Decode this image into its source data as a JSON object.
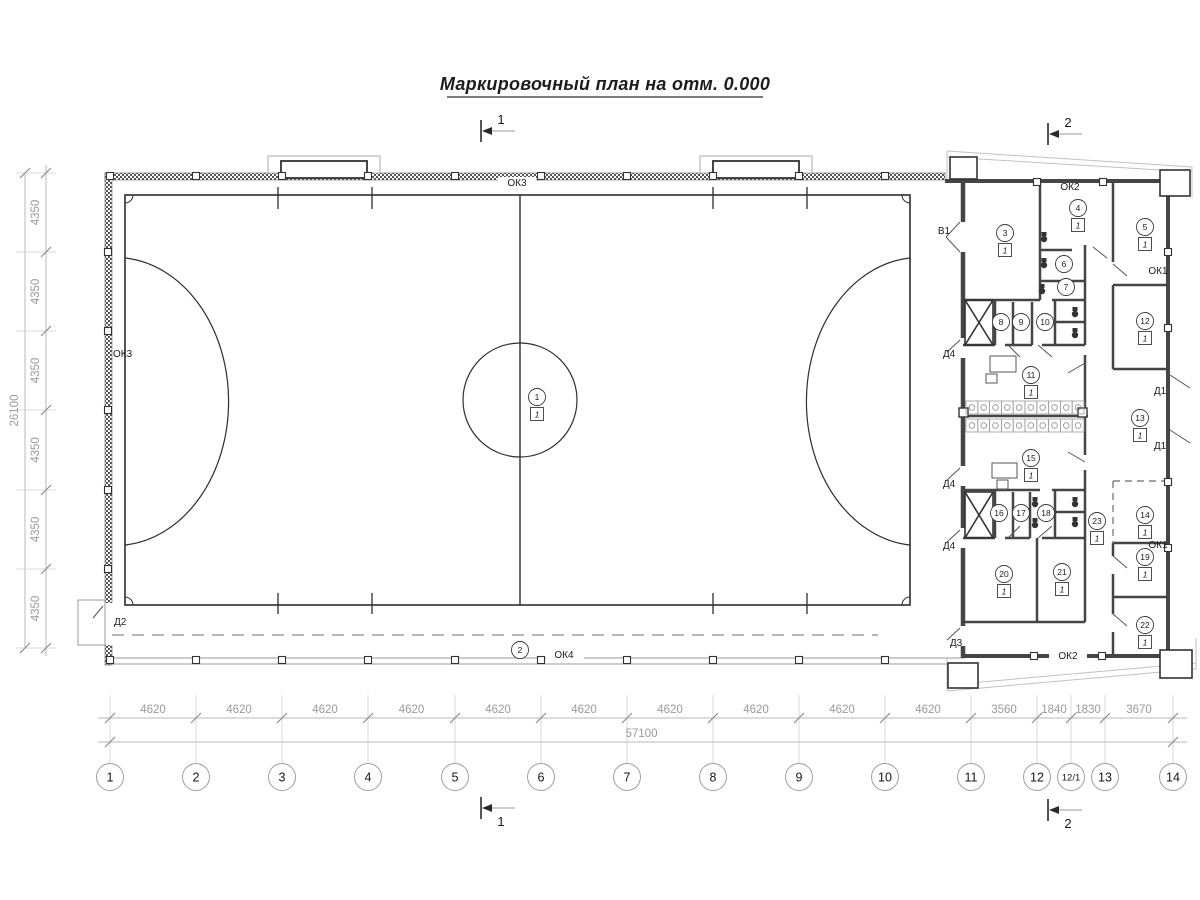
{
  "title": "Маркировочный план на отм. 0.000",
  "colors": {
    "line_dark": "#2e2e2e",
    "wall": "#454545",
    "dim_line": "#b8b8b8",
    "dim_text": "#9a9a9a",
    "label_text": "#1c1c1c",
    "dash": "#888888"
  },
  "plan": {
    "axes_x": [
      {
        "name": "1",
        "x": 110
      },
      {
        "name": "2",
        "x": 196
      },
      {
        "name": "3",
        "x": 282
      },
      {
        "name": "4",
        "x": 368
      },
      {
        "name": "5",
        "x": 455
      },
      {
        "name": "6",
        "x": 541
      },
      {
        "name": "7",
        "x": 627
      },
      {
        "name": "8",
        "x": 713
      },
      {
        "name": "9",
        "x": 799
      },
      {
        "name": "10",
        "x": 885
      },
      {
        "name": "11",
        "x": 971
      },
      {
        "name": "12",
        "x": 1037
      },
      {
        "name": "12/1",
        "x": 1071
      },
      {
        "name": "13",
        "x": 1105
      },
      {
        "name": "14",
        "x": 1173
      }
    ],
    "dims_x": [
      "4620",
      "4620",
      "4620",
      "4620",
      "4620",
      "4620",
      "4620",
      "4620",
      "4620",
      "4620",
      "3560",
      "1840",
      "1830",
      "3670"
    ],
    "total_x": "57100",
    "ys": [
      173,
      252,
      331,
      410,
      490,
      569,
      648
    ],
    "dims_y": [
      "4350",
      "4350",
      "4350",
      "4350",
      "4350",
      "4350"
    ],
    "total_y": "26100",
    "box_mark": "1",
    "rooms": [
      {
        "num": "1",
        "cx": 537,
        "cy": 397,
        "boxed": true
      },
      {
        "num": "2",
        "cx": 520,
        "cy": 650,
        "boxed": false
      },
      {
        "num": "3",
        "cx": 1005,
        "cy": 233,
        "boxed": true
      },
      {
        "num": "4",
        "cx": 1078,
        "cy": 208,
        "boxed": true
      },
      {
        "num": "5",
        "cx": 1145,
        "cy": 227,
        "boxed": true
      },
      {
        "num": "6",
        "cx": 1064,
        "cy": 264,
        "boxed": false
      },
      {
        "num": "7",
        "cx": 1066,
        "cy": 287,
        "boxed": false
      },
      {
        "num": "8",
        "cx": 1001,
        "cy": 322,
        "boxed": false
      },
      {
        "num": "9",
        "cx": 1021,
        "cy": 322,
        "boxed": false
      },
      {
        "num": "10",
        "cx": 1045,
        "cy": 322,
        "boxed": false
      },
      {
        "num": "11",
        "cx": 1031,
        "cy": 375,
        "boxed": true
      },
      {
        "num": "12",
        "cx": 1145,
        "cy": 321,
        "boxed": true
      },
      {
        "num": "13",
        "cx": 1140,
        "cy": 418,
        "boxed": true
      },
      {
        "num": "14",
        "cx": 1145,
        "cy": 515,
        "boxed": true
      },
      {
        "num": "15",
        "cx": 1031,
        "cy": 458,
        "boxed": true
      },
      {
        "num": "16",
        "cx": 999,
        "cy": 513,
        "boxed": false
      },
      {
        "num": "17",
        "cx": 1021,
        "cy": 513,
        "boxed": false
      },
      {
        "num": "18",
        "cx": 1046,
        "cy": 513,
        "boxed": false
      },
      {
        "num": "19",
        "cx": 1145,
        "cy": 557,
        "boxed": true
      },
      {
        "num": "20",
        "cx": 1004,
        "cy": 574,
        "boxed": true
      },
      {
        "num": "21",
        "cx": 1062,
        "cy": 572,
        "boxed": true
      },
      {
        "num": "22",
        "cx": 1145,
        "cy": 625,
        "boxed": true
      },
      {
        "num": "23",
        "cx": 1097,
        "cy": 521,
        "boxed": true
      }
    ],
    "wall_labels": [
      {
        "text": "ОК3",
        "x": 517,
        "y": 186,
        "anchor": "middle",
        "bg": [
          498,
          177,
          38,
          11
        ]
      },
      {
        "text": "ОК3",
        "x": 113,
        "y": 357,
        "anchor": "start"
      },
      {
        "text": "ОК4",
        "x": 564,
        "y": 658,
        "anchor": "middle",
        "bg": [
          546,
          649,
          38,
          11
        ]
      },
      {
        "text": "ОК2",
        "x": 1070,
        "y": 190,
        "anchor": "middle"
      },
      {
        "text": "ОК2",
        "x": 1068,
        "y": 659,
        "anchor": "middle",
        "bg": [
          1049,
          650,
          38,
          11
        ]
      },
      {
        "text": "ОК1",
        "x": 1158,
        "y": 274,
        "anchor": "middle"
      },
      {
        "text": "ОК1",
        "x": 1158,
        "y": 548,
        "anchor": "middle"
      },
      {
        "text": "В1",
        "x": 944,
        "y": 234,
        "anchor": "middle"
      },
      {
        "text": "Д4",
        "x": 949,
        "y": 357,
        "anchor": "middle"
      },
      {
        "text": "Д4",
        "x": 949,
        "y": 487,
        "anchor": "middle"
      },
      {
        "text": "Д4",
        "x": 949,
        "y": 549,
        "anchor": "middle"
      },
      {
        "text": "Д3",
        "x": 956,
        "y": 646,
        "anchor": "middle"
      },
      {
        "text": "Д2",
        "x": 114,
        "y": 625,
        "anchor": "start"
      },
      {
        "text": "Д1",
        "x": 1160,
        "y": 394,
        "anchor": "middle"
      },
      {
        "text": "Д1",
        "x": 1160,
        "y": 449,
        "anchor": "middle"
      }
    ],
    "section_markers": [
      {
        "label": "1",
        "x": 481,
        "y": 131,
        "pos": "above"
      },
      {
        "label": "1",
        "x": 481,
        "y": 808,
        "pos": "below"
      },
      {
        "label": "2",
        "x": 1048,
        "y": 134,
        "pos": "above"
      },
      {
        "label": "2",
        "x": 1048,
        "y": 810,
        "pos": "below"
      }
    ]
  }
}
